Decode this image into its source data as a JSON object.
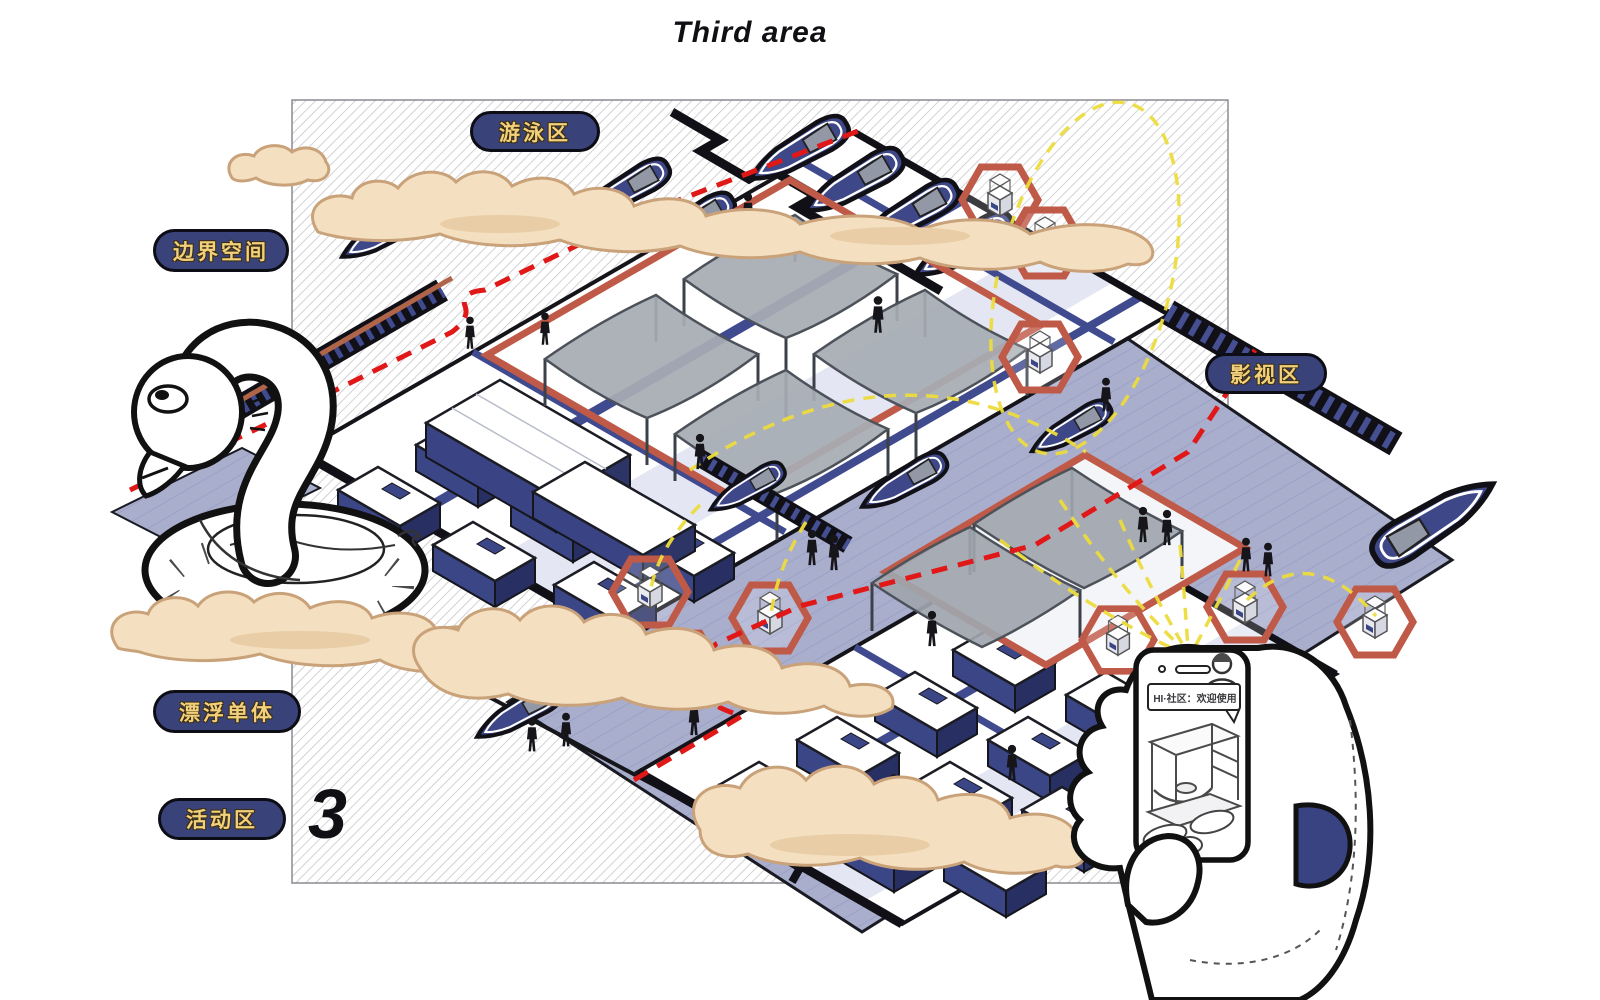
{
  "title": "Third area",
  "plate_number": "3",
  "zone_labels": {
    "swimming": "游泳区",
    "boundary_space": "边界空间",
    "film": "影视区",
    "floating_unit": "漂浮单体",
    "activity": "活动区"
  },
  "phone": {
    "bubble_text": "HI·社区：欢迎使用"
  },
  "colors": {
    "navy_dark": "#272f63",
    "navy_mid": "#3b4687",
    "water_lavender": "#a9aecd",
    "cloud_fill": "#f4e0c0",
    "cloud_outline": "#c9a27a",
    "route_red": "#e11818",
    "boundary_salmon": "#c05a48",
    "signal_yellow": "#ecdc3e",
    "canopy_grey": "#a7acb4",
    "label_background": "#3a4379",
    "label_text": "#f2d07c",
    "hatch_line": "#c4c4c8"
  }
}
